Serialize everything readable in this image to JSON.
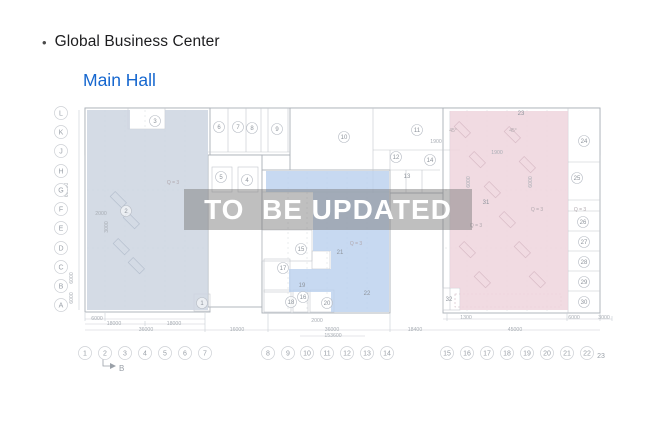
{
  "header": {
    "bullet": "•",
    "title": "Global Business Center",
    "subtitle": "Main Hall"
  },
  "watermark": "TO  BE UPDATED",
  "colors": {
    "accent_blue": "#1667cf",
    "title_color": "#1d1d1f",
    "left_region": "#ccd5e1",
    "middle_region": "#b9cfee",
    "right_region": "#eed5dd",
    "watermark_bg": "rgba(122,122,122,0.48)",
    "watermark_text": "#ffffff",
    "wall_line": "#aab0b7",
    "axis_text": "#9aa0a8",
    "dim_text": "#a8adb4"
  },
  "plan": {
    "section_marker": "B",
    "row_axis": [
      {
        "label": "L",
        "y": 113
      },
      {
        "label": "K",
        "y": 132
      },
      {
        "label": "J",
        "y": 151
      },
      {
        "label": "H",
        "y": 171
      },
      {
        "label": "G",
        "y": 190
      },
      {
        "label": "F",
        "y": 209
      },
      {
        "label": "E",
        "y": 228
      },
      {
        "label": "D",
        "y": 248
      },
      {
        "label": "C",
        "y": 267
      },
      {
        "label": "B",
        "y": 286
      },
      {
        "label": "A",
        "y": 305
      }
    ],
    "col_axis": [
      {
        "label": "1",
        "x": 85
      },
      {
        "label": "2",
        "x": 105
      },
      {
        "label": "3",
        "x": 125
      },
      {
        "label": "4",
        "x": 145
      },
      {
        "label": "5",
        "x": 165
      },
      {
        "label": "6",
        "x": 185
      },
      {
        "label": "7",
        "x": 205
      },
      {
        "label": "8",
        "x": 268
      },
      {
        "label": "9",
        "x": 288
      },
      {
        "label": "10",
        "x": 307
      },
      {
        "label": "11",
        "x": 327
      },
      {
        "label": "12",
        "x": 347
      },
      {
        "label": "13",
        "x": 367
      },
      {
        "label": "14",
        "x": 387
      },
      {
        "label": "15",
        "x": 447
      },
      {
        "label": "16",
        "x": 467
      },
      {
        "label": "17",
        "x": 487
      },
      {
        "label": "18",
        "x": 507
      },
      {
        "label": "19",
        "x": 527
      },
      {
        "label": "20",
        "x": 547
      },
      {
        "label": "21",
        "x": 567
      },
      {
        "label": "22",
        "x": 587
      }
    ],
    "col_axis_extra": {
      "label": "23",
      "x": 601,
      "y": 358
    },
    "rooms": [
      {
        "n": "1",
        "x": 202,
        "y": 303,
        "c": 1
      },
      {
        "n": "2",
        "x": 126,
        "y": 211,
        "c": 1
      },
      {
        "n": "3",
        "x": 155,
        "y": 121,
        "c": 1
      },
      {
        "n": "4",
        "x": 247,
        "y": 180,
        "c": 1
      },
      {
        "n": "5",
        "x": 221,
        "y": 177,
        "c": 1
      },
      {
        "n": "6",
        "x": 219,
        "y": 127,
        "c": 1
      },
      {
        "n": "7",
        "x": 238,
        "y": 127,
        "c": 1
      },
      {
        "n": "8",
        "x": 252,
        "y": 128,
        "c": 1
      },
      {
        "n": "9",
        "x": 277,
        "y": 129,
        "c": 1
      },
      {
        "n": "10",
        "x": 344,
        "y": 137,
        "c": 1
      },
      {
        "n": "11",
        "x": 417,
        "y": 130,
        "c": 1
      },
      {
        "n": "12",
        "x": 396,
        "y": 157,
        "c": 1
      },
      {
        "n": "13",
        "x": 407,
        "y": 176,
        "c": 0
      },
      {
        "n": "14",
        "x": 430,
        "y": 160,
        "c": 1
      },
      {
        "n": "15",
        "x": 301,
        "y": 249,
        "c": 1
      },
      {
        "n": "16",
        "x": 303,
        "y": 297,
        "c": 1
      },
      {
        "n": "17",
        "x": 283,
        "y": 268,
        "c": 1
      },
      {
        "n": "18",
        "x": 291,
        "y": 302,
        "c": 1
      },
      {
        "n": "19",
        "x": 302,
        "y": 285,
        "c": 0
      },
      {
        "n": "20",
        "x": 327,
        "y": 303,
        "c": 1
      },
      {
        "n": "21",
        "x": 340,
        "y": 252,
        "c": 0
      },
      {
        "n": "22",
        "x": 367,
        "y": 293,
        "c": 0
      },
      {
        "n": "23",
        "x": 521,
        "y": 113,
        "c": 0
      },
      {
        "n": "24",
        "x": 584,
        "y": 141,
        "c": 1
      },
      {
        "n": "25",
        "x": 577,
        "y": 178,
        "c": 1
      },
      {
        "n": "26",
        "x": 583,
        "y": 222,
        "c": 1
      },
      {
        "n": "27",
        "x": 584,
        "y": 242,
        "c": 1
      },
      {
        "n": "28",
        "x": 584,
        "y": 262,
        "c": 1
      },
      {
        "n": "29",
        "x": 584,
        "y": 282,
        "c": 1
      },
      {
        "n": "30",
        "x": 584,
        "y": 302,
        "c": 1
      },
      {
        "n": "31",
        "x": 486,
        "y": 202,
        "c": 0
      },
      {
        "n": "32",
        "x": 449,
        "y": 299,
        "c": 0
      }
    ],
    "dims": [
      {
        "t": "6000",
        "x": 97,
        "y": 320
      },
      {
        "t": "18000",
        "x": 114,
        "y": 325
      },
      {
        "t": "18000",
        "x": 174,
        "y": 325
      },
      {
        "t": "36000",
        "x": 146,
        "y": 331
      },
      {
        "t": "16000",
        "x": 237,
        "y": 331
      },
      {
        "t": "2000",
        "x": 317,
        "y": 322
      },
      {
        "t": "36000",
        "x": 332,
        "y": 331
      },
      {
        "t": "153600",
        "x": 333,
        "y": 337
      },
      {
        "t": "18400",
        "x": 415,
        "y": 331
      },
      {
        "t": "1300",
        "x": 466,
        "y": 319
      },
      {
        "t": "45000",
        "x": 515,
        "y": 331
      },
      {
        "t": "6000",
        "x": 574,
        "y": 319
      },
      {
        "t": "3000",
        "x": 604,
        "y": 319
      },
      {
        "t": "1900",
        "x": 436,
        "y": 143
      },
      {
        "t": "1900",
        "x": 497,
        "y": 154
      },
      {
        "t": "2000",
        "x": 101,
        "y": 215
      },
      {
        "t": "60000",
        "x": 68,
        "y": 190,
        "v": 1
      },
      {
        "t": "6000",
        "x": 73,
        "y": 278,
        "v": 1
      },
      {
        "t": "6000",
        "x": 73,
        "y": 298,
        "v": 1
      },
      {
        "t": "3000",
        "x": 108,
        "y": 227,
        "v": 1
      },
      {
        "t": "6000",
        "x": 470,
        "y": 182,
        "v": 1
      },
      {
        "t": "6000",
        "x": 532,
        "y": 182,
        "v": 1
      }
    ],
    "notes": [
      {
        "t": "Q = 3",
        "x": 173,
        "y": 184
      },
      {
        "t": "Q = 3",
        "x": 356,
        "y": 245
      },
      {
        "t": "Q = 3",
        "x": 476,
        "y": 227
      },
      {
        "t": "Q = 3",
        "x": 537,
        "y": 211
      },
      {
        "t": "Q = 3",
        "x": 580,
        "y": 211
      },
      {
        "t": "45°",
        "x": 453,
        "y": 132
      },
      {
        "t": "45°",
        "x": 513,
        "y": 132
      }
    ]
  }
}
